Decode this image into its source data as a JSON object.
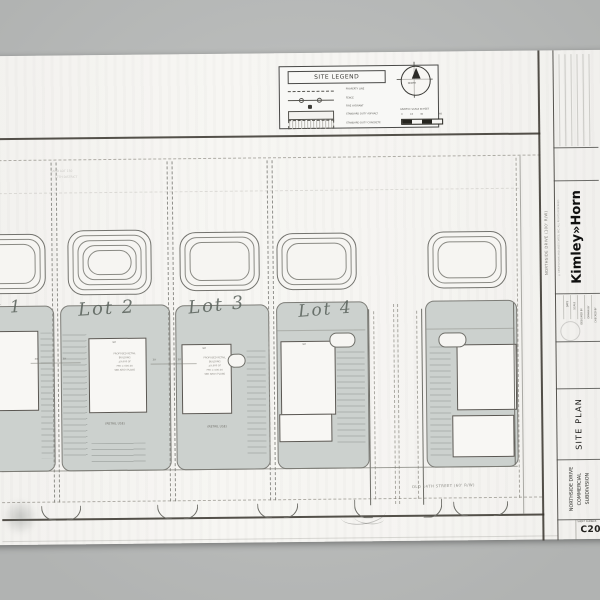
{
  "legend": {
    "title": "SITE LEGEND",
    "items": [
      {
        "label": "PROPERTY LINE"
      },
      {
        "label": "FENCE"
      },
      {
        "label": "FIRE HYDRANT"
      },
      {
        "label": "STANDARD DUTY ASPHALT"
      },
      {
        "label": "STANDARD DUTY CONCRETE"
      }
    ]
  },
  "compass": {
    "label": "NORTH"
  },
  "scale": {
    "caption": "GRAPHIC SCALE IN FEET",
    "ticks": [
      "0",
      "15",
      "30",
      "60"
    ]
  },
  "site": {
    "lots": [
      {
        "label": "Lot 1"
      },
      {
        "label": "Lot 2"
      },
      {
        "label": "Lot 3"
      },
      {
        "label": "Lot 4"
      }
    ],
    "street_label": "OLD 14TH STREET (60' R/W)",
    "right_street_label": "NORTHSIDE DRIVE (100' R/W)",
    "parcel_note_line1": "LAND LOT 150",
    "parcel_note_line2": "17TH DISTRICT",
    "building_width_dim": "90'",
    "setback_dim": "30'",
    "use_caption": "(RETAIL USE)",
    "building_notes": [
      "PROPOSED RETAIL",
      "BUILDING",
      "±9,600 SF",
      "FFE = 000.00",
      "SEE ARCH PLANS"
    ]
  },
  "titleblock": {
    "firm": "Kimley»Horn",
    "copyright": "© KIMLEY-HORN AND ASSOCIATES, INC. ALL RIGHTS RESERVED",
    "sheet_title": "SITE PLAN",
    "project_name_lines": [
      "NORTHSIDE DRIVE",
      "COMMERCIAL",
      "SUBDIVISION"
    ],
    "sheet_number_label": "SHEET NUMBER",
    "sheet_number": "C20",
    "info_fields": [
      "DATE",
      "SCALE",
      "DESIGNED BY",
      "DRAWN BY",
      "CHECKED BY"
    ]
  }
}
